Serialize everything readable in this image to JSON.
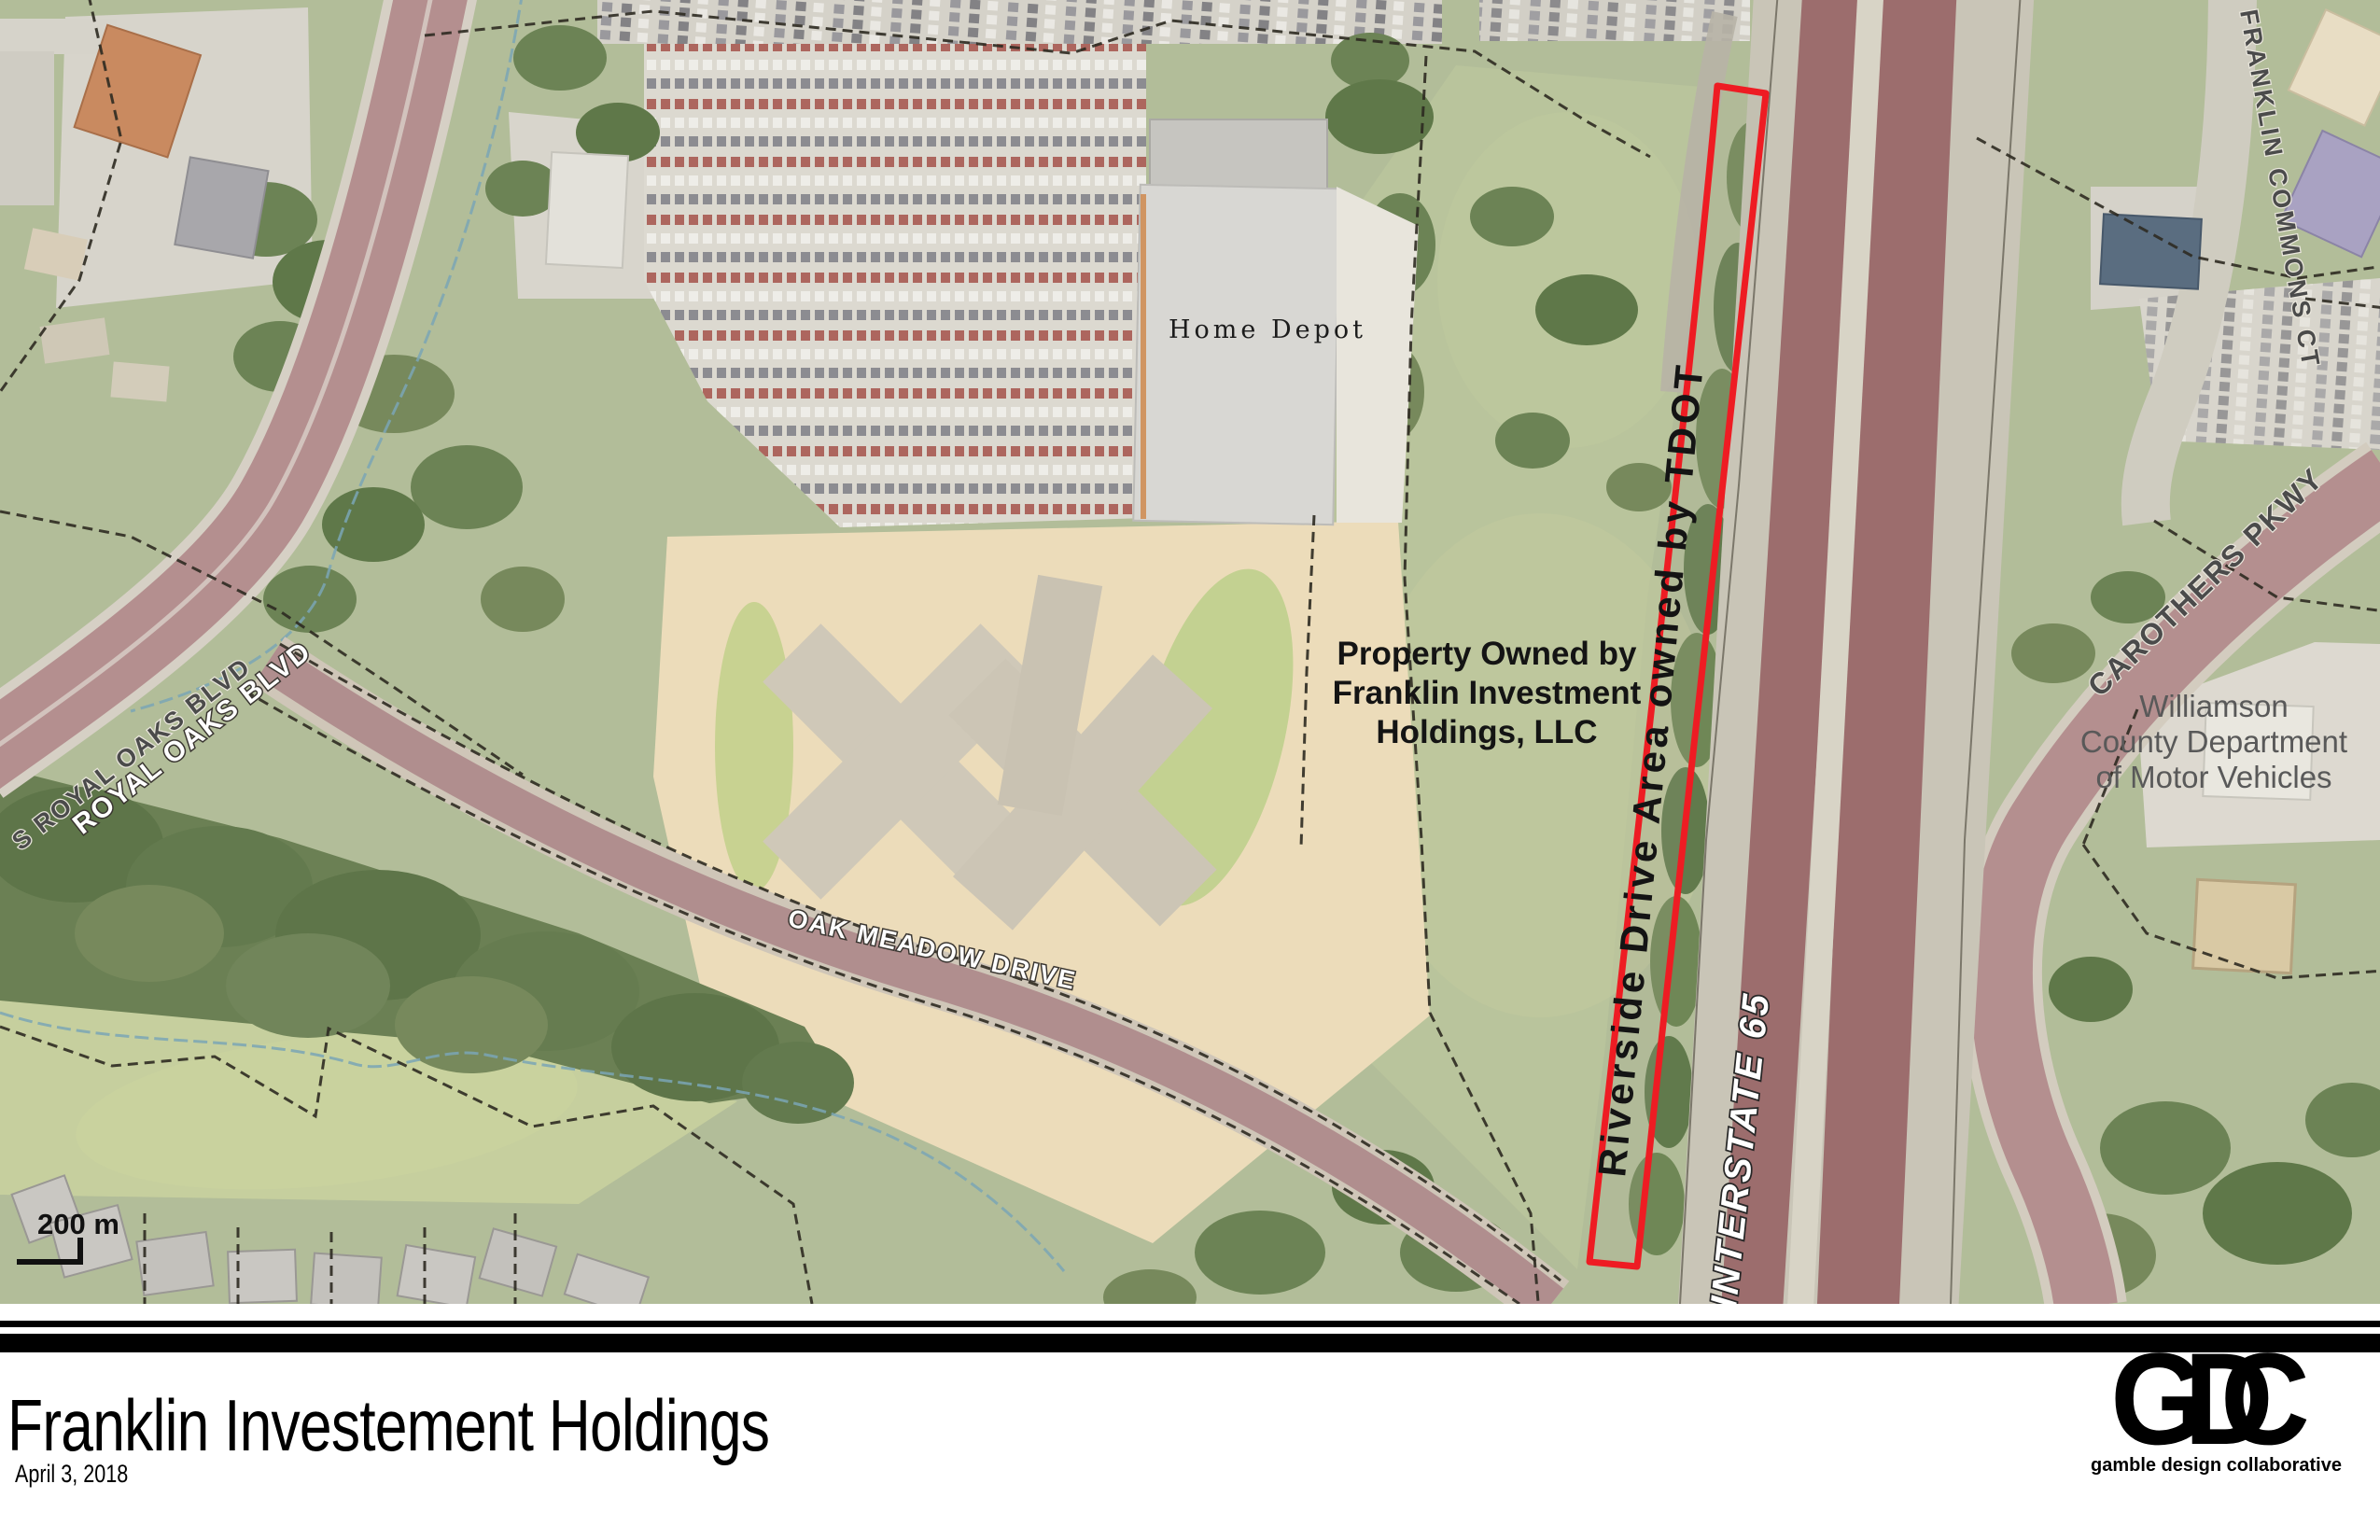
{
  "map": {
    "aerial_labels": {
      "home_depot": "Home Depot",
      "property_line1": "Property Owned by",
      "property_line2": "Franklin Investment",
      "property_line3": "Holdings, LLC",
      "riverside_strip": "Riverside Drive Area owned by TDOT",
      "interstate": "INTERSTATE 65",
      "oak_meadow_drive": "OAK MEADOW DRIVE",
      "royal_oaks_blvd": "ROYAL OAKS BLVD",
      "s_royal_oaks_blvd": "S ROYAL OAKS BLVD",
      "franklin_commons_ct": "FRANKLIN COMMONS CT",
      "carothers_pkwy": "CAROTHERS PKWY",
      "dmv_line1": "Williamson",
      "dmv_line2": "County Department",
      "dmv_line3": "of Motor Vehicles"
    },
    "scale_bar": {
      "label": "200 m"
    },
    "colors": {
      "parcel_outline_red": "#ee1c23",
      "highway_lane": "#9c6d6d",
      "arterial_road": "#b48f8f",
      "aerial_green": "#b2bd99"
    }
  },
  "footer": {
    "title": "Franklin Investement Holdings",
    "date": "April 3, 2018",
    "logo": {
      "letter_g": "G",
      "letter_d": "D",
      "letter_c": "C",
      "tagline": "gamble design collaborative"
    }
  }
}
